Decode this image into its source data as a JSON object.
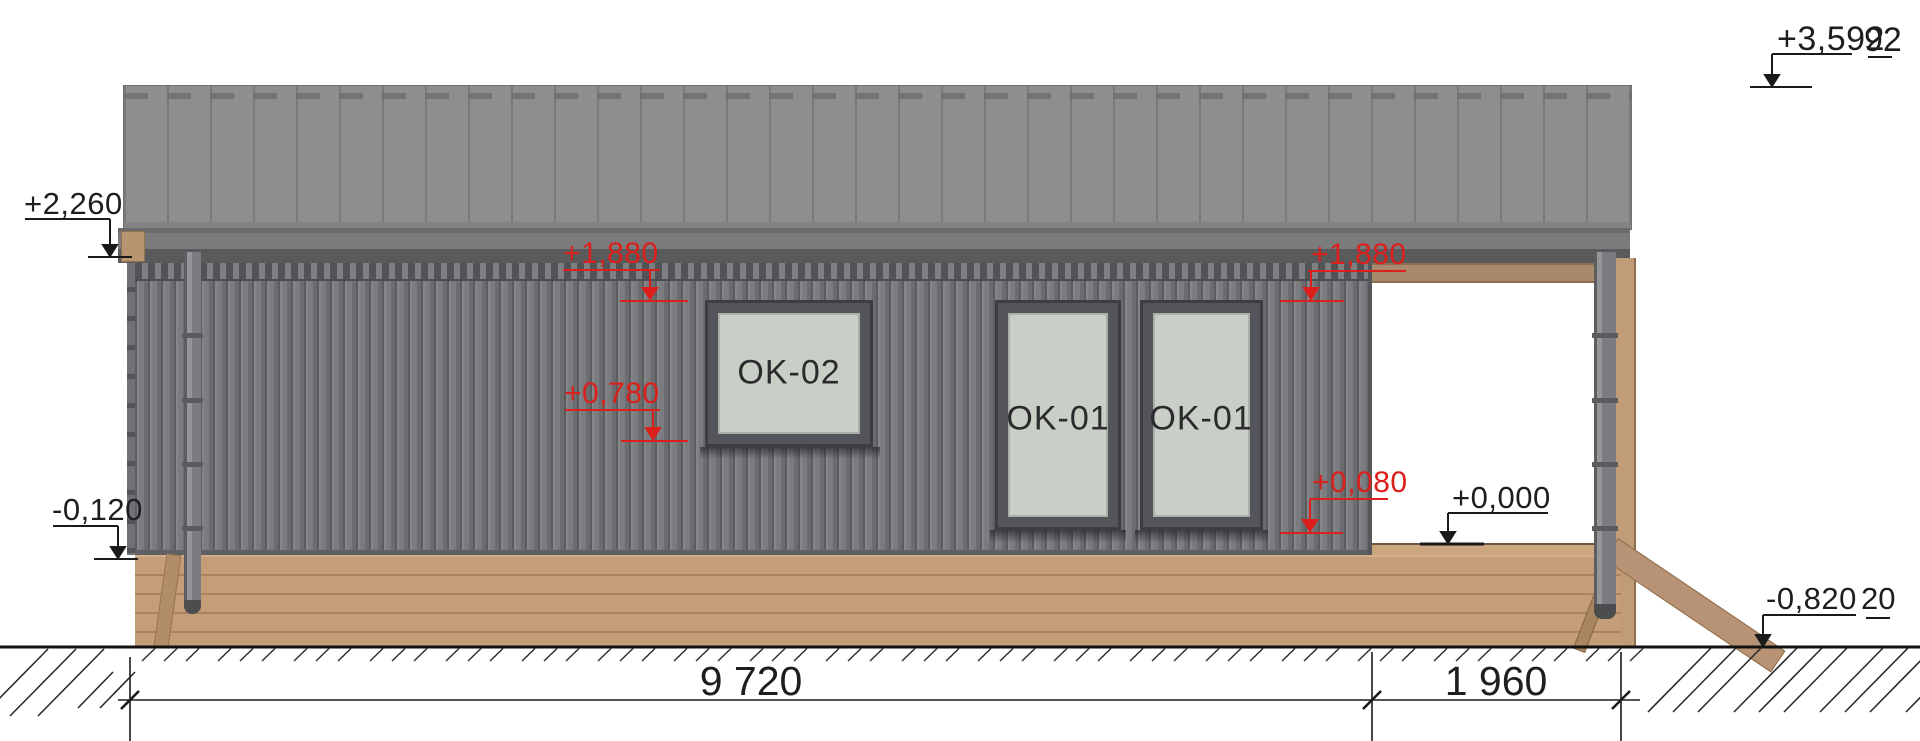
{
  "levels": {
    "ridge": {
      "value": "+3,592",
      "fragment": "92"
    },
    "eave": {
      "value": "+2,260"
    },
    "wall_base": {
      "value": "-0,120"
    },
    "floor": {
      "value": "+0,000"
    },
    "ground": {
      "value": "-0,820",
      "fragment": "20"
    },
    "window_head_left": {
      "value": "+1,880"
    },
    "window_sill_left": {
      "value": "+0,780"
    },
    "window_head_right": {
      "value": "+1,880"
    },
    "window_sill_right": {
      "value": "+0,080"
    }
  },
  "windows": [
    {
      "id": "OK-02"
    },
    {
      "id": "OK-01"
    },
    {
      "id": "OK-01"
    }
  ],
  "dimensions": {
    "main_span": "9 720",
    "porch_span": "1 960"
  },
  "colors": {
    "annotation_red": "#dc1f1a",
    "annotation_black": "#1e1e20",
    "roof_gray": "#8e8e90",
    "wall_gray": "#77787b",
    "wood_tan": "#c49e78",
    "glass": "#c9cfc7"
  }
}
